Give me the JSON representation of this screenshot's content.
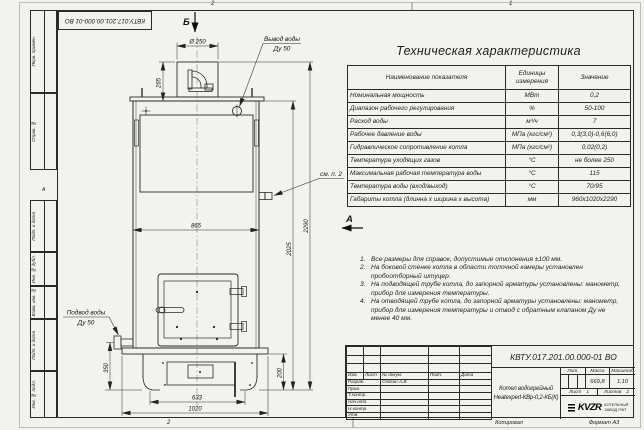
{
  "frame": {
    "stamp_rotated": "КВТУ.017.201.00.000-01 ВО",
    "left_labels": [
      "Перв. примен.",
      "Справ. №",
      "Подп. и дата",
      "Инв. № дубл.",
      "Взам. инв. №",
      "Подп. и дата",
      "Инв. № подл."
    ],
    "zones": {
      "top_left": "2",
      "top_right": "1",
      "left": "А",
      "bottom": "2"
    }
  },
  "drawing": {
    "section_marker_b": "Б",
    "view_marker_a": "А",
    "labels": {
      "outlet_line1": "Вывод воды",
      "outlet_line2": "Ду 50",
      "inlet_line1": "Подвод воды",
      "inlet_line2": "Ду 50",
      "see_note": "см. п. 2"
    },
    "dimensions": {
      "chimney_diameter": "Ø 250",
      "chimney_height": "265",
      "body_width": "865",
      "height_total": "2290",
      "height_body": "2025",
      "inlet_height": "350",
      "base_height": "200",
      "feet_span": "633",
      "base_width": "1020"
    }
  },
  "spec_table": {
    "title": "Техническая характеристика",
    "columns": [
      "Наименование показателя",
      "Единицы измерения",
      "Значение"
    ],
    "rows": [
      [
        "Номинальная мощность",
        "МВт",
        "0,2"
      ],
      [
        "Диапазон рабочего регулирования",
        "%",
        "50-100"
      ],
      [
        "Расход воды",
        "м³/ч",
        "7"
      ],
      [
        "Рабочее давление воды",
        "МПа (кгс/см²)",
        "0,3(3,0)-0,6(6,0)"
      ],
      [
        "Гидравлическое сопротивление котла",
        "МПа (кгс/см²)",
        "0,02(0,2)"
      ],
      [
        "Температура уходящих газов",
        "°С",
        "не более 250"
      ],
      [
        "Максимальная рабочая температура воды",
        "°С",
        "115"
      ],
      [
        "Температура воды (вход/выход)",
        "°С",
        "70/95"
      ],
      [
        "Габариты котла (длинна х ширина х высота)",
        "мм",
        "960х1020х2290"
      ]
    ]
  },
  "notes": [
    {
      "num": "1.",
      "text": "Все размеры для справок, допустимые отклонения ±100 мм."
    },
    {
      "num": "2.",
      "text": "На боковой стенке котла в области топочной камеры установлен пробоотборный штуцер."
    },
    {
      "num": "3.",
      "text": "На подводящей трубе котла, до запорной арматуры установлены: манометр, прибор для измерения температуры."
    },
    {
      "num": "4.",
      "text": "На отводящей трубе котла, до запорной арматуры установлены: манометр, прибор для измерения температуры и отвод с обратным клапаном Ду не менее 40 мм."
    }
  ],
  "title_block": {
    "doc_number": "КВТУ.017.201.00.000-01 ВО",
    "product_line1": "Котел водогрейный",
    "product_line2": "Heatexpert-КВр-0,2-КБ(К)",
    "change_header": [
      "Изм.",
      "Лист",
      "№ докум.",
      "Подп.",
      "Дата"
    ],
    "roles": [
      {
        "role": "Разраб.",
        "name": "Седгин А.В."
      },
      {
        "role": "Пров.",
        "name": ""
      },
      {
        "role": "Т.контр.",
        "name": ""
      },
      {
        "role": "Нач.отд.",
        "name": ""
      },
      {
        "role": "Н.контр.",
        "name": ""
      },
      {
        "role": "Утв.",
        "name": ""
      }
    ],
    "lit_label": "Лит.",
    "mass_label": "Масса",
    "scale_label": "Масштаб",
    "mass_value": "669,8",
    "scale_value": "1:10",
    "sheet_label": "Лист",
    "sheet_value": "1",
    "sheets_label": "Листов",
    "sheets_value": "2",
    "company_logo_text": "KVZR",
    "company_line1": "КОТЕЛЬНЫЙ",
    "company_line2": "ЗАВОД РЭП",
    "copied_label": "Копировал",
    "format_label": "Формат А3"
  }
}
